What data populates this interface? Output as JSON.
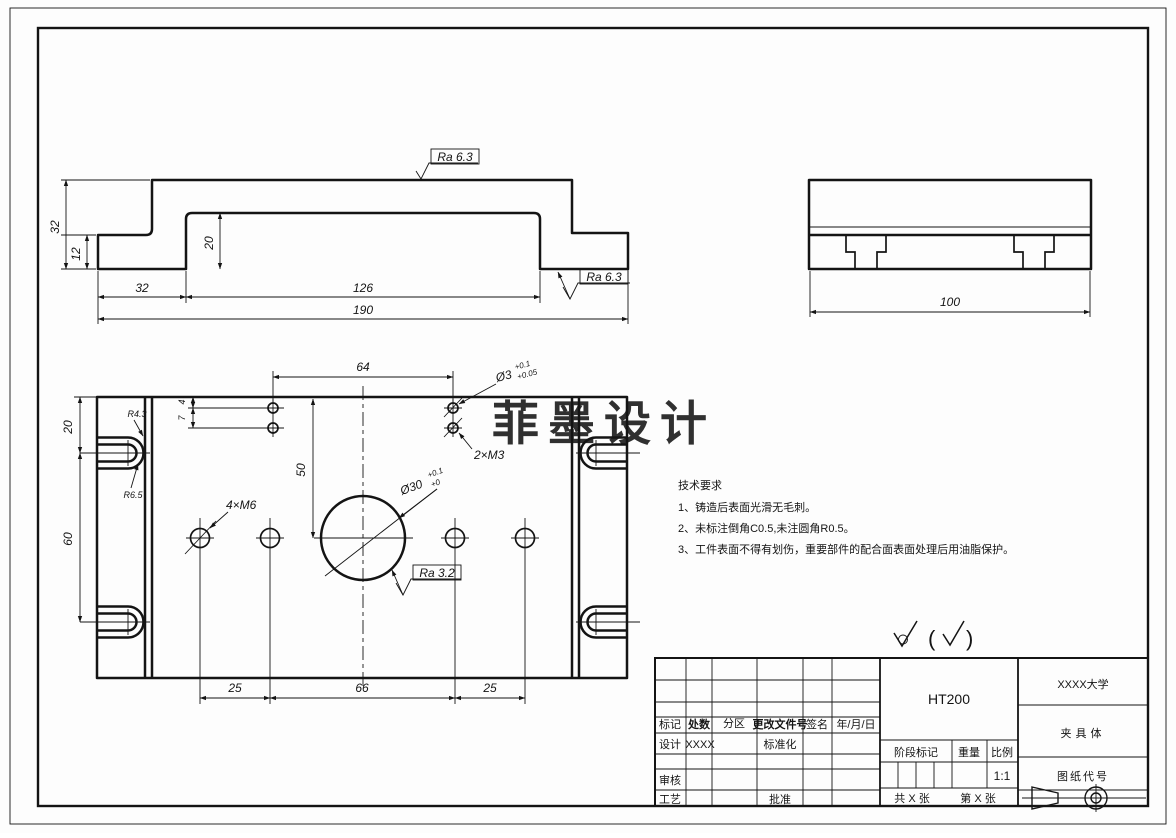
{
  "colors": {
    "ink": "#141414",
    "watermark": "#dc5f71"
  },
  "watermark": "菲墨设计",
  "front_view": {
    "height": "32",
    "flange_height": "12",
    "recess_height": "20",
    "left_width": "32",
    "recess_width": "126",
    "total_width": "190",
    "ra_top": "Ra 6.3",
    "ra_step": "Ra 6.3"
  },
  "side_view": {
    "depth": "100"
  },
  "plan_view": {
    "hole_span": "64",
    "edge_offset": "4",
    "pair_gap": "7",
    "slot_top_offset": "20",
    "slot_spacing": "60",
    "row_offset": "50",
    "bolt_span_left": "25",
    "bolt_span_mid": "66",
    "bolt_span_right": "25",
    "radius_outer": "R4.3",
    "radius_inner": "R6.5",
    "callout_m6": "4×M6",
    "callout_m3": "2×M3",
    "callout_d3": "Ø3",
    "d3_tol_upper": "+0.1",
    "d3_tol_lower": "+0.05",
    "callout_d30": "Ø30",
    "d30_tol_upper": "+0.1",
    "d30_tol_lower": "+0",
    "ra_bore": "Ra 3.2"
  },
  "tech_notes": {
    "title": "技术要求",
    "item1": "1、铸造后表面光滑无毛刺。",
    "item2": "2、未标注倒角C0.5,未注圆角R0.5。",
    "item3": "3、工件表面不得有划伤，重要部件的配合面表面处理后用油脂保护。"
  },
  "surface_note": {
    "paren_open": "(",
    "paren_close": ")"
  },
  "title_block": {
    "mark": "标记",
    "count": "处数",
    "zone": "分区",
    "change_doc_no": "更改文件号",
    "signature": "签名",
    "date": "年/月/日",
    "design": "设计",
    "designer": "XXXX",
    "standardization": "标准化",
    "review": "审核",
    "process": "工艺",
    "approve": "批准",
    "material": "HT200",
    "stage_mark": "阶段标记",
    "weight": "重量",
    "scale_label": "比例",
    "scale_value": "1:1",
    "sheets_total": "共 X 张",
    "sheet_number": "第 X 张",
    "organization": "XXXX大学",
    "part_name": "夹具体",
    "drawing_code": "图纸代号"
  }
}
